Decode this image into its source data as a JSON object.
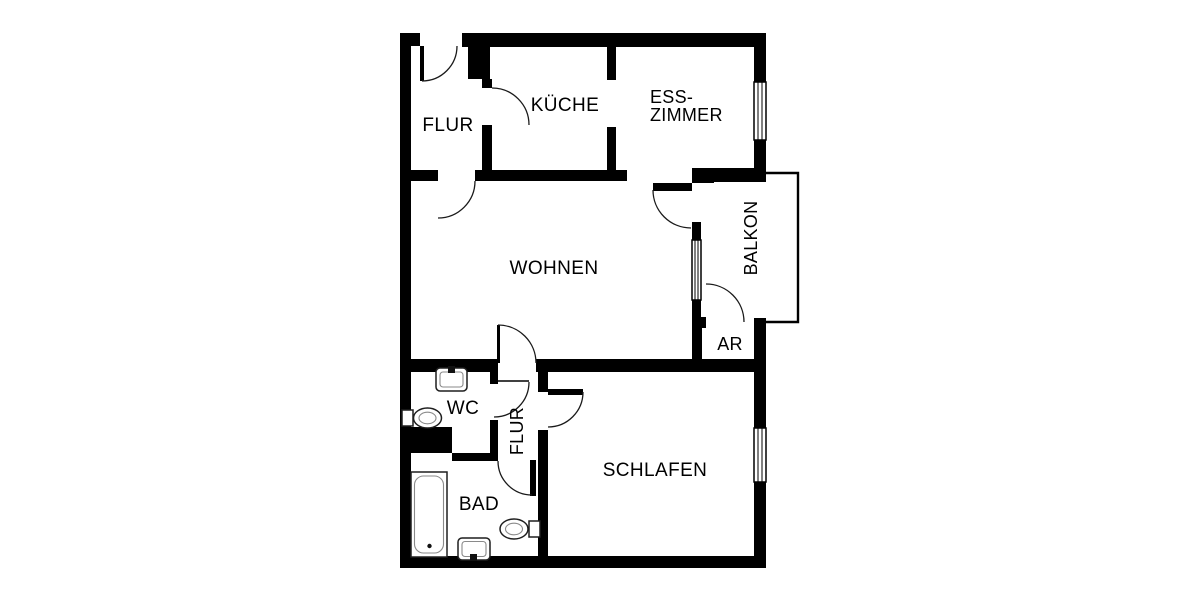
{
  "plan": {
    "background_color": "#ffffff",
    "wall_color": "#000000",
    "fixture_stroke_color": "#1f1f1f",
    "rooms": {
      "flur_entry": {
        "label": "FLUR"
      },
      "kueche": {
        "label": "KÜCHE"
      },
      "esszimmer": {
        "label_line1": "ESS-",
        "label_line2": "ZIMMER"
      },
      "wohnen": {
        "label": "WOHNEN"
      },
      "balkon": {
        "label": "BALKON"
      },
      "abstellraum": {
        "label": "AR"
      },
      "wc": {
        "label": "WC"
      },
      "flur_inner": {
        "label": "FLUR"
      },
      "schlafen": {
        "label": "SCHLAFEN"
      },
      "bad": {
        "label": "BAD"
      }
    },
    "fixtures": [
      "bathtub-icon",
      "toilet-icon",
      "washbasin-icon",
      "toilet-icon",
      "washbasin-icon"
    ],
    "windows": 3,
    "doors": 9
  }
}
